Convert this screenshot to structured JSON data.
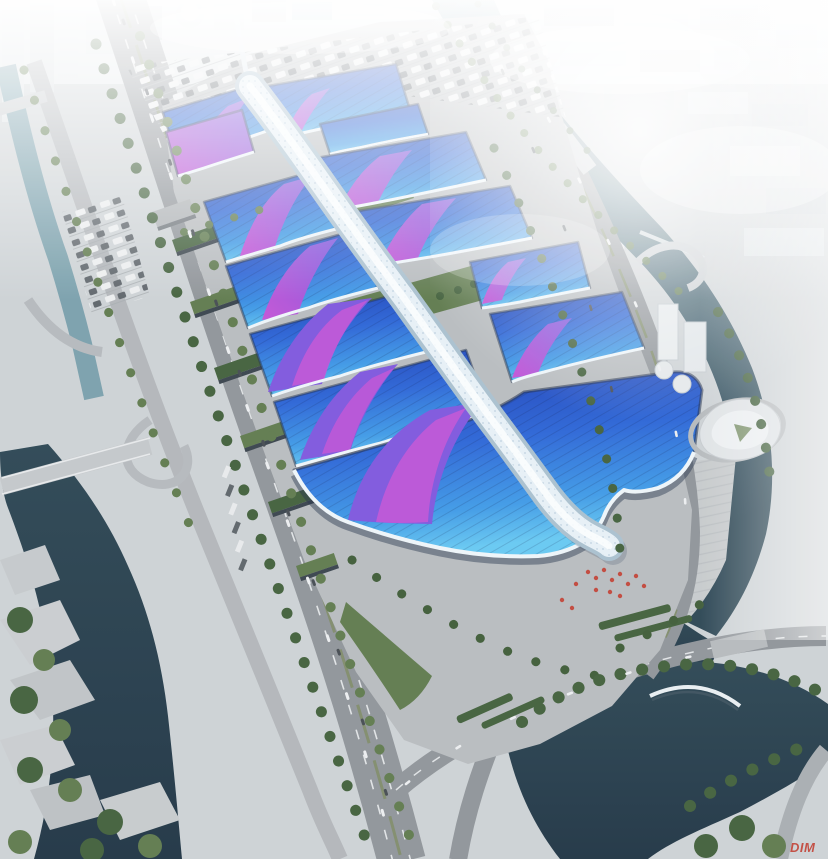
{
  "watermark": {
    "text": "DIM"
  },
  "palette": {
    "haze": "#f4f7f8",
    "city": "#dde3e6",
    "cityShade": "#c5cdd2",
    "ground": "#cdd2d5",
    "apron": "#b8bcbf",
    "plaza": "#c6cacc",
    "road": "#8f9499",
    "roadLight": "#b2b6ba",
    "lane": "#e0e3e5",
    "canal": "#7aa0ac",
    "waterDeep": "#2c4654",
    "waterDark": "#203544",
    "green": "#5f7a4e",
    "greenDark": "#42603c",
    "roofDeep": "#1d3db2",
    "roofMid": "#2b64d6",
    "roofLite": "#3f9ae6",
    "roofCyan": "#66c8f2",
    "violet": "#7e57dd",
    "magenta": "#c453d6",
    "trim": "#eef5f9",
    "spineBase": "#a9c0cf",
    "spineBody": "#e7f0f6",
    "spineHi": "#fbfdfe",
    "facadeDark": "#22304a",
    "red": "#c23b2e"
  }
}
